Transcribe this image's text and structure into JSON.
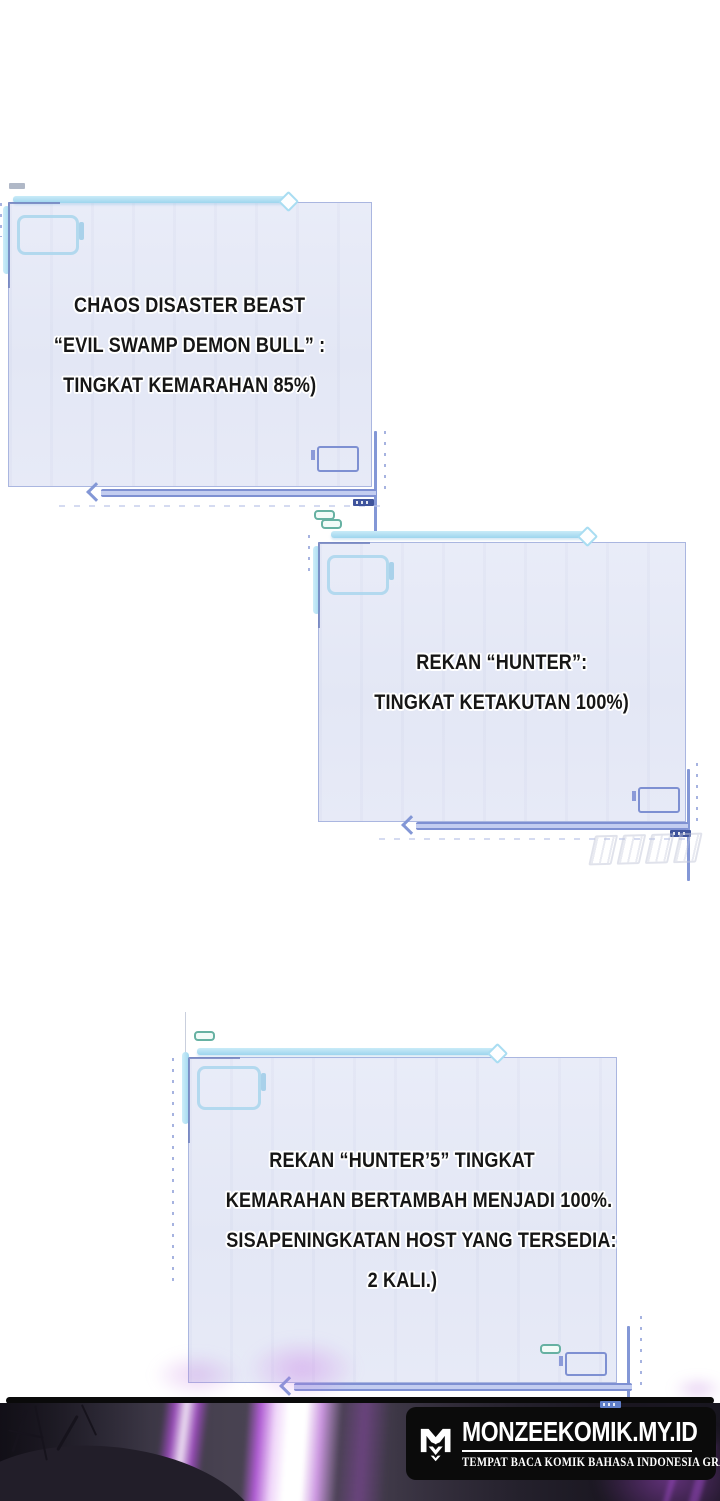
{
  "system_boxes": [
    {
      "lines": [
        "CHAOS DISASTER BEAST",
        "“EVIL SWAMP DEMON BULL” :",
        "TINGKAT KEMARAHAN 85%)"
      ]
    },
    {
      "lines": [
        "REKAN “HUNTER”:",
        "TINGKAT KETAKUTAN 100%)"
      ]
    },
    {
      "lines": [
        "REKAN “HUNTER’5” TINGKAT",
        "KEMARAHAN BERTAMBAH MENJADI 100%.",
        "SISAPENINGKATAN HOST YANG TERSEDIA:",
        "2 KALI.)"
      ]
    }
  ],
  "footer": {
    "site_title": "MONZEEKOMIK.MY.ID",
    "tagline": "TEMPAT BACA KOMIK BAHASA INDONESIA GRATIS"
  },
  "watermark": {
    "glyph_count": 4
  },
  "colors": {
    "page_background": "#ffffff",
    "box_fill": "#e6e9f6",
    "box_border": "#aab6e0",
    "decor_cyan": "#a2d8ef",
    "decor_periwinkle": "#7e90d2",
    "decor_navy": "#3f549c",
    "text_color": "#161616",
    "text_outline": "#ffffff",
    "badge_background": "#0b0b0b",
    "badge_text": "#ffffff",
    "beam_purple": "#b14fd8",
    "strip_background": "#3a3443"
  }
}
